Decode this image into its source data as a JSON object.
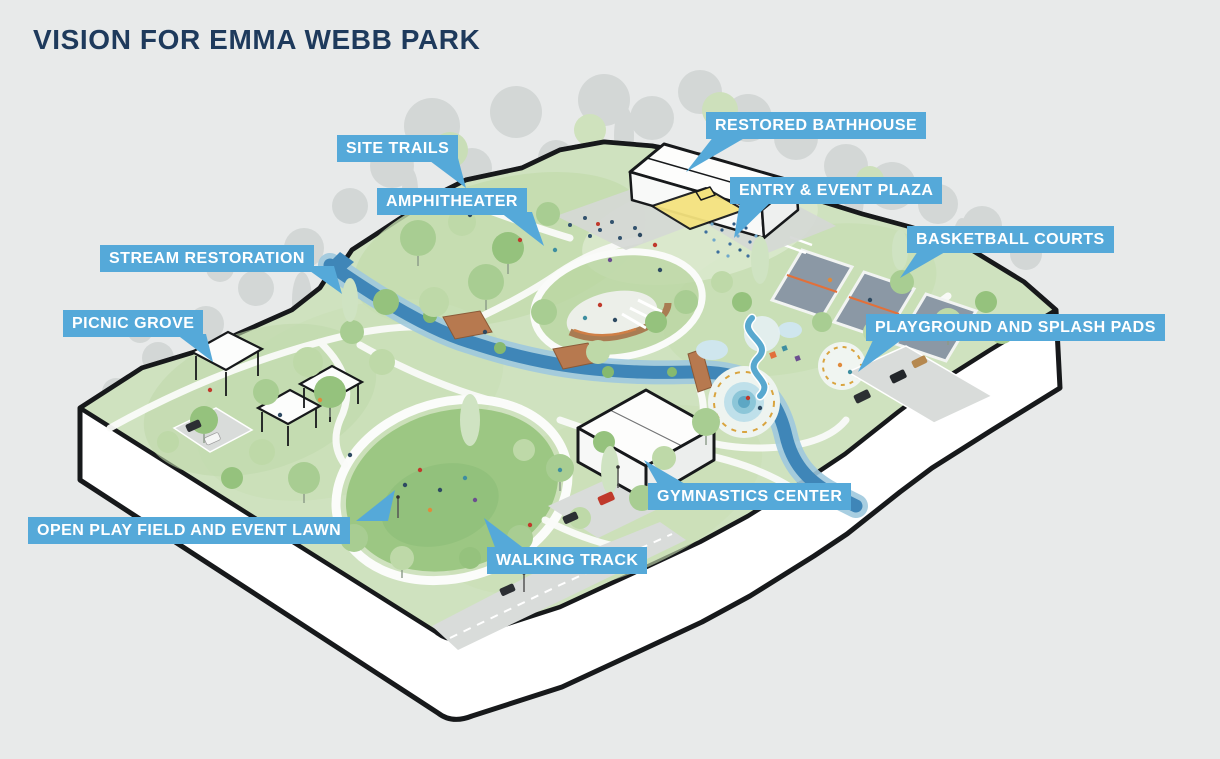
{
  "title": "VISION FOR EMMA WEBB PARK",
  "labels": {
    "restored_bathhouse": "RESTORED BATHHOUSE",
    "site_trails": "SITE TRAILS",
    "entry_event_plaza": "ENTRY & EVENT PLAZA",
    "amphitheater": "AMPHITHEATER",
    "basketball_courts": "BASKETBALL COURTS",
    "stream_restoration": "STREAM RESTORATION",
    "picnic_grove": "PICNIC GROVE",
    "playground_splash_pads": "PLAYGROUND AND SPLASH PADS",
    "gymnastics_center": "GYMNASTICS CENTER",
    "open_play_field": "OPEN PLAY FIELD AND EVENT LAWN",
    "walking_track": "WALKING TRACK"
  },
  "colors": {
    "background": "#e8eaea",
    "callout_background": "#55a9d9",
    "callout_text": "#ffffff",
    "title_text": "#1e3a5c",
    "park_green": "#cfe2bf",
    "lawn_green": "#9cc783",
    "stream_blue": "#3f86b8",
    "court_gray": "#8b98a5",
    "court_line_orange": "#e2703a",
    "building_white": "#fdfdfc",
    "bathhouse_court_yellow": "#f4e27e",
    "outline_black": "#17191b"
  }
}
